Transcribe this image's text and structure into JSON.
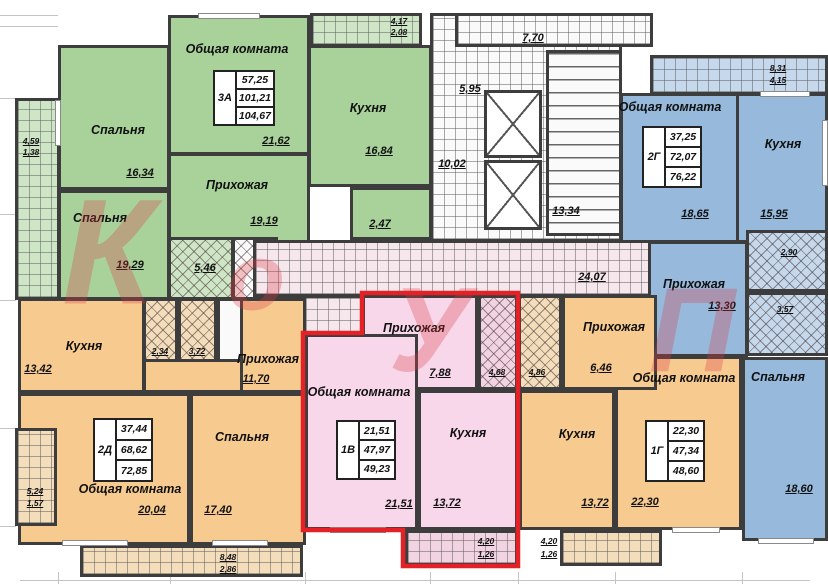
{
  "watermark": {
    "l1": "К",
    "l2": "о",
    "l3": "У",
    "l4": "П"
  },
  "common": {
    "corridor_area": "24,07",
    "lobby_area_1": "5,95",
    "lobby_area_2": "10,02",
    "stairs_area": "13,34",
    "core_balcony_area": "7,70"
  },
  "colors": {
    "green": "#a9d29b",
    "blue": "#96b9dc",
    "orange": "#f7cb90",
    "pink": "#f7d7e9",
    "highlight": "#e32126"
  },
  "apartments": {
    "green_3a": {
      "code": "3А",
      "stats": [
        "57,25",
        "101,21",
        "104,67"
      ],
      "living": {
        "label": "Общая комната",
        "area": "21,62"
      },
      "kitchen": {
        "label": "Кухня",
        "area": "16,84"
      },
      "bedroom1": {
        "label": "Спальня",
        "area": "16,34"
      },
      "bedroom2": {
        "label": "Спальня",
        "area": "19,29"
      },
      "hall": {
        "label": "Прихожая",
        "area": "19,19"
      },
      "bath": {
        "area": "5,46"
      },
      "wc": {
        "area": "2,47"
      },
      "balcony_top": {
        "a1": "4,17",
        "a2": "2,08"
      },
      "balcony_left": {
        "a1": "4,59",
        "a2": "1,38"
      }
    },
    "blue_2g": {
      "code": "2Г",
      "stats": [
        "37,25",
        "72,07",
        "76,22"
      ],
      "living": {
        "label": "Общая комната",
        "area": "18,65"
      },
      "kitchen": {
        "label": "Кухня",
        "area": "15,95"
      },
      "hall": {
        "label": "Прихожая",
        "area": "13,30"
      },
      "bedroom": {
        "label": "Спальня",
        "area": "18,60"
      },
      "loggia1": {
        "area": "2,90"
      },
      "loggia2": {
        "area": "3,57"
      },
      "balcony_top": {
        "a1": "8,31",
        "a2": "4,15"
      }
    },
    "orange_2d": {
      "code": "2Д",
      "stats": [
        "37,44",
        "68,62",
        "72,85"
      ],
      "kitchen": {
        "label": "Кухня",
        "area": "13,42"
      },
      "hall": {
        "label": "Прихожая",
        "area": "11,70"
      },
      "living": {
        "label": "Общая комната",
        "area": "20,04"
      },
      "bedroom": {
        "label": "Спальня",
        "area": "17,40"
      },
      "bath1": {
        "area": "2,34"
      },
      "bath2": {
        "area": "3,72"
      },
      "balcony_left": {
        "a1": "5,24",
        "a2": "1,57"
      },
      "balcony_bottom": {
        "a1": "8,48",
        "a2": "2,86"
      }
    },
    "pink_1v": {
      "code": "1В",
      "stats": [
        "21,51",
        "47,97",
        "49,23"
      ],
      "living": {
        "label": "Общая комната",
        "area": "21,51"
      },
      "kitchen": {
        "label": "Кухня",
        "area": "13,72"
      },
      "hall": {
        "label": "Прихожая",
        "area": "7,88"
      },
      "bath": {
        "area": "4,68"
      },
      "balcony": {
        "a1": "4,20",
        "a2": "1,26"
      }
    },
    "orange_1g": {
      "code": "1Г",
      "stats": [
        "22,30",
        "47,34",
        "48,60"
      ],
      "living": {
        "label": "Общая комната",
        "area": "22,30"
      },
      "kitchen": {
        "label": "Кухня",
        "area": "13,72"
      },
      "hall": {
        "label": "Прихожая",
        "area": "6,46"
      },
      "bath": {
        "area": "4,86"
      },
      "balcony": {
        "a1": "4,20",
        "a2": "1,26"
      }
    }
  }
}
